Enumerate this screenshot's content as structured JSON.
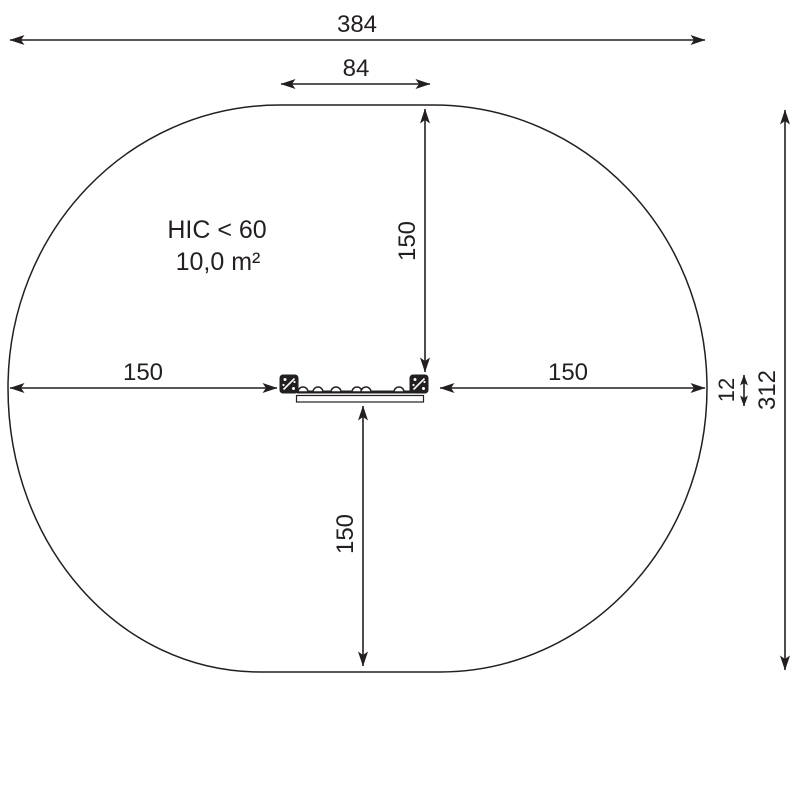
{
  "diagram": {
    "notes": {
      "hic": "HIC < 60",
      "area": "10,0 m²"
    },
    "dimensions": {
      "overall_width": "384",
      "top_flat_width": "84",
      "clearance_top": "150",
      "clearance_left": "150",
      "clearance_right": "150",
      "clearance_bottom": "150",
      "beam_depth": "12",
      "overall_height": "312"
    },
    "colors": {
      "ink": "#231f20",
      "background": "#ffffff"
    }
  }
}
